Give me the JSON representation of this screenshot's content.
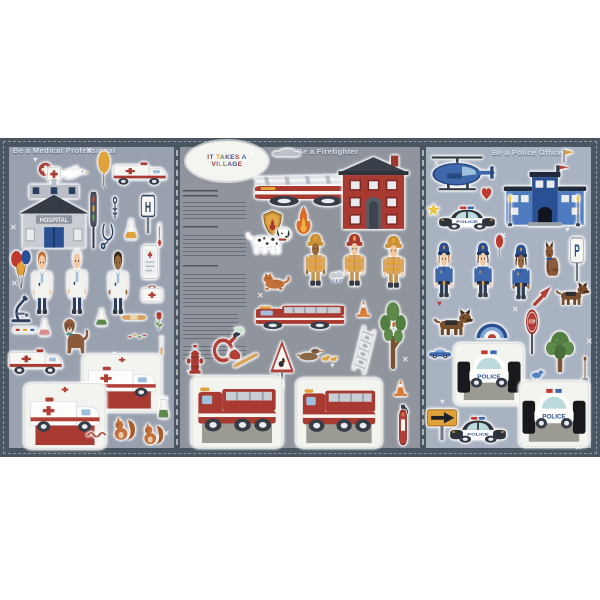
{
  "logo": {
    "text": "IT TAKES A VILLAGE"
  },
  "titles": {
    "medical": "Be a Medical Professional",
    "fire": "Be a Firefighter",
    "police": "Be a Police Officer"
  },
  "labels": {
    "hospital": "HOSPITAL",
    "hospital_sign": "H",
    "parking_sign": "P",
    "stop_sign": "STOP",
    "police_car": "POLICE"
  },
  "colors": {
    "frame": "#4a5661",
    "medical_bg": "#99a1af",
    "fire_bg": "#90959d",
    "police_bg": "#a9b2c1",
    "accent_red": "#a93a32",
    "accent_blue": "#3f68ac",
    "accent_yellow": "#e2a23b",
    "sheet_white": "#f3f3f0"
  },
  "panels": [
    {
      "id": "medical",
      "stickers": [
        {
          "name": "red-cross-badge-icon",
          "icon": "crossbadge",
          "x": 38,
          "y": 162,
          "w": 15,
          "h": 15
        },
        {
          "name": "dove-icon",
          "icon": "dove",
          "x": 56,
          "y": 160,
          "w": 34,
          "h": 26
        },
        {
          "name": "yellow-balloon-icon",
          "icon": "balloon",
          "c": "#e2a23b",
          "x": 92,
          "y": 150,
          "w": 24,
          "h": 40
        },
        {
          "name": "ambulance-top-icon",
          "icon": "ambulance",
          "x": 112,
          "y": 154,
          "w": 57,
          "h": 38
        },
        {
          "name": "hospital-building-icon",
          "icon": "hospital",
          "x": 13,
          "y": 166,
          "w": 82,
          "h": 85
        },
        {
          "name": "traffic-light-icon",
          "icon": "trafficlight",
          "x": 85,
          "y": 190,
          "w": 17,
          "h": 60
        },
        {
          "name": "caduceus-icon",
          "icon": "caduceus",
          "x": 107,
          "y": 196,
          "w": 16,
          "h": 26
        },
        {
          "name": "hospital-sign-icon",
          "icon": "hsign",
          "x": 136,
          "y": 194,
          "w": 24,
          "h": 40
        },
        {
          "name": "stethoscope-icon",
          "icon": "stethoscope",
          "x": 97,
          "y": 222,
          "w": 22,
          "h": 30
        },
        {
          "name": "flask-yellow-icon",
          "icon": "flask",
          "c": "#e2a23b",
          "x": 122,
          "y": 218,
          "w": 18,
          "h": 24
        },
        {
          "name": "thermometer-icon",
          "icon": "thermometer",
          "x": 154,
          "y": 222,
          "w": 11,
          "h": 26
        },
        {
          "name": "balloon-bunch-icon",
          "icon": "balloons",
          "x": 8,
          "y": 248,
          "w": 28,
          "h": 42
        },
        {
          "name": "doctor-1",
          "icon": "doctor",
          "skin": "#f2c9a4",
          "hair": "#c4703b",
          "x": 26,
          "y": 250,
          "w": 32,
          "h": 66
        },
        {
          "name": "doctor-2",
          "icon": "doctor",
          "skin": "#f2c9a4",
          "hair": "#e8e8e6",
          "x": 61,
          "y": 248,
          "w": 32,
          "h": 68
        },
        {
          "name": "doctor-3",
          "icon": "doctor",
          "skin": "#9a6a3f",
          "hair": "#3a2a1e",
          "x": 102,
          "y": 250,
          "w": 32,
          "h": 66
        },
        {
          "name": "medical-chart-icon",
          "icon": "tablet",
          "x": 138,
          "y": 244,
          "w": 24,
          "h": 36
        },
        {
          "name": "first-aid-kit-icon",
          "icon": "firstaid",
          "x": 140,
          "y": 284,
          "w": 24,
          "h": 20
        },
        {
          "name": "microscope-icon",
          "icon": "microscope",
          "x": 7,
          "y": 294,
          "w": 28,
          "h": 30
        },
        {
          "name": "pill-strip-icon",
          "icon": "pillstrip",
          "x": 12,
          "y": 324,
          "w": 26,
          "h": 12
        },
        {
          "name": "flask-pink-icon",
          "icon": "flask",
          "c": "#d98a8a",
          "x": 36,
          "y": 318,
          "w": 17,
          "h": 20
        },
        {
          "name": "therapy-dog-icon",
          "icon": "dogbrown",
          "x": 58,
          "y": 312,
          "w": 32,
          "h": 44
        },
        {
          "name": "flask-green-icon",
          "icon": "flask",
          "c": "#5d8a4a",
          "x": 93,
          "y": 308,
          "w": 17,
          "h": 20
        },
        {
          "name": "bandage-icon",
          "icon": "bandage",
          "x": 121,
          "y": 311,
          "w": 26,
          "h": 13
        },
        {
          "name": "flower-icon",
          "icon": "flower",
          "x": 151,
          "y": 309,
          "w": 16,
          "h": 24
        },
        {
          "name": "sprinkles-icon",
          "icon": "sprinkle",
          "x": 126,
          "y": 331,
          "w": 22,
          "h": 11
        },
        {
          "name": "test-tube-icon",
          "icon": "testtube",
          "x": 156,
          "y": 336,
          "w": 11,
          "h": 22
        },
        {
          "name": "ambulance-side-icon",
          "icon": "ambulance",
          "x": 8,
          "y": 340,
          "w": 57,
          "h": 42
        },
        {
          "name": "ambulance-sheet-1",
          "icon": "ambsheet",
          "x": 82,
          "y": 354,
          "w": 80,
          "h": 58
        },
        {
          "name": "ambulance-sheet-2",
          "icon": "ambsheet",
          "x": 24,
          "y": 383,
          "w": 82,
          "h": 66
        },
        {
          "name": "worm-icon",
          "icon": "worm",
          "x": 86,
          "y": 426,
          "w": 24,
          "h": 15
        },
        {
          "name": "squirrel-1-icon",
          "icon": "squirrel",
          "x": 110,
          "y": 414,
          "w": 29,
          "h": 30
        },
        {
          "name": "squirrel-2-icon",
          "icon": "squirrel",
          "x": 140,
          "y": 420,
          "w": 27,
          "h": 28
        },
        {
          "name": "beaker-icon",
          "icon": "beaker",
          "x": 155,
          "y": 396,
          "w": 17,
          "h": 24
        }
      ]
    },
    {
      "id": "fire",
      "stickers": [
        {
          "name": "cloud-icon",
          "icon": "cloud",
          "x": 270,
          "y": 146,
          "w": 32,
          "h": 13
        },
        {
          "name": "ladder-fire-truck-icon",
          "icon": "laddertruck",
          "x": 252,
          "y": 163,
          "w": 146,
          "h": 50
        },
        {
          "name": "fire-station-icon",
          "icon": "firestation",
          "x": 337,
          "y": 154,
          "w": 73,
          "h": 78
        },
        {
          "name": "fire-badge-icon",
          "icon": "shield",
          "x": 261,
          "y": 210,
          "w": 23,
          "h": 27
        },
        {
          "name": "flame-icon",
          "icon": "flame",
          "x": 291,
          "y": 205,
          "w": 25,
          "h": 31
        },
        {
          "name": "dalmatian-icon",
          "icon": "dalmatian",
          "x": 246,
          "y": 220,
          "w": 48,
          "h": 42
        },
        {
          "name": "firefighter-1",
          "icon": "firefighter",
          "skin": "#9a6a3f",
          "helmet": "#c99036",
          "x": 299,
          "y": 231,
          "w": 33,
          "h": 57
        },
        {
          "name": "firefighter-2",
          "icon": "firefighter",
          "skin": "#f2c9a4",
          "helmet": "#a93a32",
          "x": 338,
          "y": 231,
          "w": 33,
          "h": 57
        },
        {
          "name": "firefighter-3",
          "icon": "firefighter",
          "skin": "#f2c9a4",
          "helmet": "#c99036",
          "x": 376,
          "y": 233,
          "w": 35,
          "h": 57
        },
        {
          "name": "cat-icon",
          "icon": "cat",
          "x": 260,
          "y": 268,
          "w": 34,
          "h": 26
        },
        {
          "name": "rain-cloud-icon",
          "icon": "raincloud",
          "x": 328,
          "y": 270,
          "w": 18,
          "h": 16
        },
        {
          "name": "fire-truck-icon",
          "icon": "firetruck",
          "x": 254,
          "y": 298,
          "w": 94,
          "h": 38
        },
        {
          "name": "traffic-cone-1-icon",
          "icon": "cone",
          "x": 354,
          "y": 298,
          "w": 19,
          "h": 21
        },
        {
          "name": "tall-tree-icon",
          "icon": "treetall",
          "x": 374,
          "y": 300,
          "w": 38,
          "h": 72
        },
        {
          "name": "ladder-icon",
          "icon": "ladder",
          "x": 346,
          "y": 326,
          "w": 36,
          "h": 48
        },
        {
          "name": "fire-hose-icon",
          "icon": "hose",
          "x": 208,
          "y": 326,
          "w": 36,
          "h": 42
        },
        {
          "name": "fire-hydrant-icon",
          "icon": "hydrant",
          "x": 183,
          "y": 343,
          "w": 24,
          "h": 32
        },
        {
          "name": "axe-icon",
          "icon": "axe",
          "x": 226,
          "y": 344,
          "w": 38,
          "h": 32
        },
        {
          "name": "duck-crossing-sign-icon",
          "icon": "ducksign",
          "x": 269,
          "y": 340,
          "w": 26,
          "h": 50
        },
        {
          "name": "duck-family-icon",
          "icon": "duckfamily",
          "x": 296,
          "y": 344,
          "w": 42,
          "h": 24
        },
        {
          "name": "fire-engine-sheet-1",
          "icon": "firesheet",
          "x": 191,
          "y": 376,
          "w": 92,
          "h": 72
        },
        {
          "name": "fire-engine-sheet-2",
          "icon": "firesheet",
          "x": 296,
          "y": 378,
          "w": 86,
          "h": 70
        },
        {
          "name": "traffic-cone-2-icon",
          "icon": "cone",
          "x": 391,
          "y": 378,
          "w": 19,
          "h": 20
        },
        {
          "name": "fire-extinguisher-icon",
          "icon": "extinguisher",
          "x": 393,
          "y": 403,
          "w": 20,
          "h": 45
        }
      ]
    },
    {
      "id": "police",
      "stickers": [
        {
          "name": "pennant-flag-icon",
          "icon": "flagbadge",
          "x": 559,
          "y": 148,
          "w": 17,
          "h": 16
        },
        {
          "name": "police-helicopter-icon",
          "icon": "helicopter",
          "x": 428,
          "y": 154,
          "w": 68,
          "h": 44
        },
        {
          "name": "police-station-icon",
          "icon": "policestation",
          "x": 502,
          "y": 164,
          "w": 86,
          "h": 66
        },
        {
          "name": "lamppost-1-icon",
          "icon": "lamppost",
          "x": 504,
          "y": 194,
          "w": 12,
          "h": 34
        },
        {
          "name": "lamppost-2-icon",
          "icon": "lamppost",
          "x": 572,
          "y": 194,
          "w": 12,
          "h": 34
        },
        {
          "name": "star-icon",
          "icon": "star",
          "x": 426,
          "y": 202,
          "w": 15,
          "h": 15
        },
        {
          "name": "heart-icon",
          "icon": "heart",
          "x": 480,
          "y": 186,
          "w": 13,
          "h": 15
        },
        {
          "name": "police-car-top-icon",
          "icon": "policecar",
          "x": 438,
          "y": 204,
          "w": 58,
          "h": 32
        },
        {
          "name": "red-balloon-icon",
          "icon": "balloon",
          "c": "#c0392f",
          "x": 492,
          "y": 234,
          "w": 15,
          "h": 24
        },
        {
          "name": "police-officer-1",
          "icon": "officer",
          "skin": "#f2c9a4",
          "hair": "#c4703b",
          "x": 429,
          "y": 239,
          "w": 30,
          "h": 60
        },
        {
          "name": "police-officer-2",
          "icon": "officer",
          "skin": "#f2c9a4",
          "hair": "#6b4a2e",
          "x": 468,
          "y": 239,
          "w": 30,
          "h": 60
        },
        {
          "name": "police-officer-3",
          "icon": "officer",
          "skin": "#9a6a3f",
          "hair": "#3a2a1e",
          "x": 506,
          "y": 241,
          "w": 30,
          "h": 60
        },
        {
          "name": "police-dog-sitting-icon",
          "icon": "policedog",
          "x": 539,
          "y": 238,
          "w": 26,
          "h": 42
        },
        {
          "name": "parking-sign-icon",
          "icon": "psign",
          "x": 566,
          "y": 236,
          "w": 22,
          "h": 46
        },
        {
          "name": "red-arrow-icon",
          "icon": "redarrow",
          "x": 529,
          "y": 283,
          "w": 26,
          "h": 26
        },
        {
          "name": "police-dog-running-icon",
          "icon": "shepherd",
          "x": 556,
          "y": 281,
          "w": 36,
          "h": 30
        },
        {
          "name": "german-shepherd-icon",
          "icon": "shepherd",
          "x": 434,
          "y": 308,
          "w": 42,
          "h": 34
        },
        {
          "name": "rainbow-icon",
          "icon": "rainbow",
          "x": 475,
          "y": 310,
          "w": 34,
          "h": 32
        },
        {
          "name": "stop-sign-icon",
          "icon": "stopsign",
          "x": 521,
          "y": 309,
          "w": 22,
          "h": 46
        },
        {
          "name": "round-tree-icon",
          "icon": "treeround",
          "x": 541,
          "y": 328,
          "w": 38,
          "h": 46
        },
        {
          "name": "blue-car-icon",
          "icon": "carblue",
          "x": 428,
          "y": 344,
          "w": 24,
          "h": 18
        },
        {
          "name": "police-car-sheet-1",
          "icon": "policesheet",
          "x": 454,
          "y": 343,
          "w": 70,
          "h": 62
        },
        {
          "name": "bird-icon",
          "icon": "bird",
          "x": 529,
          "y": 366,
          "w": 18,
          "h": 16
        },
        {
          "name": "shovel-icon",
          "icon": "shovel",
          "x": 578,
          "y": 356,
          "w": 14,
          "h": 46
        },
        {
          "name": "police-car-sheet-2",
          "icon": "policesheet",
          "x": 519,
          "y": 381,
          "w": 70,
          "h": 66
        },
        {
          "name": "arrow-sign-icon",
          "icon": "arrowsign",
          "x": 426,
          "y": 403,
          "w": 32,
          "h": 38
        },
        {
          "name": "police-car-bottom-icon",
          "icon": "policecar",
          "x": 449,
          "y": 414,
          "w": 58,
          "h": 36
        }
      ]
    }
  ],
  "decals": [
    {
      "ch": "✕",
      "x": 86,
      "y": 147
    },
    {
      "ch": "♥",
      "x": 33,
      "y": 156
    },
    {
      "ch": "✕",
      "x": 148,
      "y": 191
    },
    {
      "ch": "✕",
      "x": 10,
      "y": 224
    },
    {
      "ch": "♥",
      "x": 59,
      "y": 236
    },
    {
      "ch": "♥",
      "x": 147,
      "y": 250
    },
    {
      "ch": "✕",
      "x": 11,
      "y": 280
    },
    {
      "ch": "♥",
      "x": 118,
      "y": 298
    },
    {
      "ch": "✕",
      "x": 44,
      "y": 360
    },
    {
      "ch": "♥",
      "x": 112,
      "y": 350
    },
    {
      "ch": "✕",
      "x": 163,
      "y": 430
    },
    {
      "ch": "✕",
      "x": 352,
      "y": 218
    },
    {
      "ch": "✕",
      "x": 257,
      "y": 292
    },
    {
      "ch": "✕",
      "x": 352,
      "y": 282
    },
    {
      "ch": "✕",
      "x": 398,
      "y": 268
    },
    {
      "ch": "♥",
      "x": 330,
      "y": 362
    },
    {
      "ch": "♥",
      "x": 186,
      "y": 368
    },
    {
      "ch": "✕",
      "x": 402,
      "y": 356
    },
    {
      "ch": "♥",
      "x": 250,
      "y": 150
    },
    {
      "ch": "✕",
      "x": 433,
      "y": 160
    },
    {
      "ch": "✕",
      "x": 500,
      "y": 232
    },
    {
      "ch": "♥",
      "x": 565,
      "y": 226
    },
    {
      "ch": "♥",
      "x": 437,
      "y": 300,
      "c": "#b04038"
    },
    {
      "ch": "✕",
      "x": 512,
      "y": 306
    },
    {
      "ch": "✕",
      "x": 586,
      "y": 338
    },
    {
      "ch": "♥",
      "x": 440,
      "y": 398
    },
    {
      "ch": "✕",
      "x": 575,
      "y": 444
    }
  ]
}
